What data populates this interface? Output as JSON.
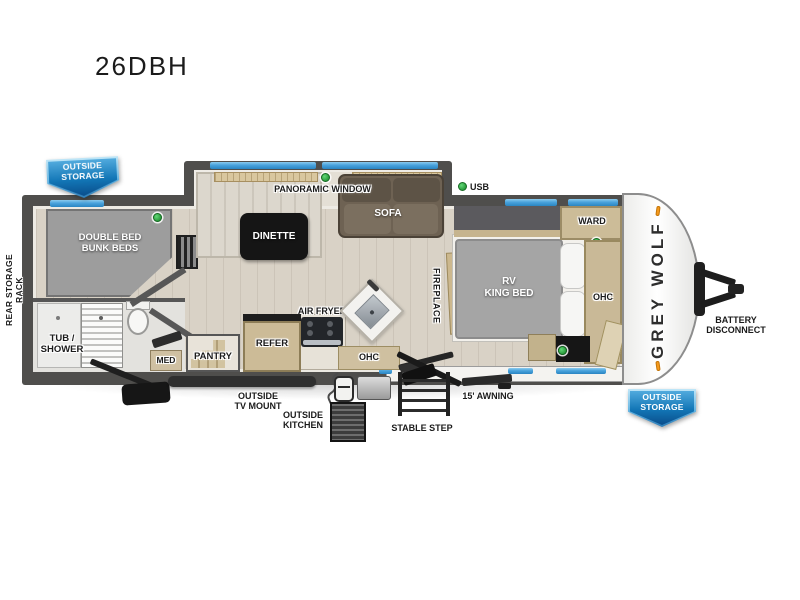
{
  "title": "26DBH",
  "brand": "GREY WOLF",
  "badges": {
    "top_left": "OUTSIDE\nSTORAGE",
    "bottom_right": "OUTSIDE\nSTORAGE"
  },
  "exterior_labels": {
    "rear_storage_rack": "REAR STORAGE RACK",
    "usb": "USB",
    "battery_disconnect": "BATTERY\nDISCONNECT",
    "outside_tv_mount": "OUTSIDE\nTV MOUNT",
    "outside_kitchen": "OUTSIDE\nKITCHEN",
    "stable_step": "STABLE STEP",
    "awning": "15' AWNING"
  },
  "interior_labels": {
    "bunks": "DOUBLE BED\nBUNK BEDS",
    "tub_shower": "TUB /\nSHOWER",
    "med": "MED",
    "pantry": "PANTRY",
    "refer": "REFER",
    "air_fryer": "AIR FRYER",
    "ohc_kitchen": "OHC",
    "ohc_bedroom": "OHC",
    "dinette": "DINETTE",
    "sofa": "SOFA",
    "panoramic_window": "PANORAMIC WINDOW",
    "fireplace": "FIREPLACE",
    "king_bed": "RV\nKING BED",
    "ward": "WARD"
  },
  "colors": {
    "wall_gray": "#4f4e4c",
    "floor_wood": "#d9d2c6",
    "window_blue": "#4aa3dc",
    "badge_blue": "#0d5a9e",
    "led_green": "#35b34a",
    "marker_orange": "#f59a1d",
    "cabinet_wood": "#ccbb97",
    "sofa_brown": "#6e6253",
    "mattress_gray": "#a5a5a5"
  }
}
